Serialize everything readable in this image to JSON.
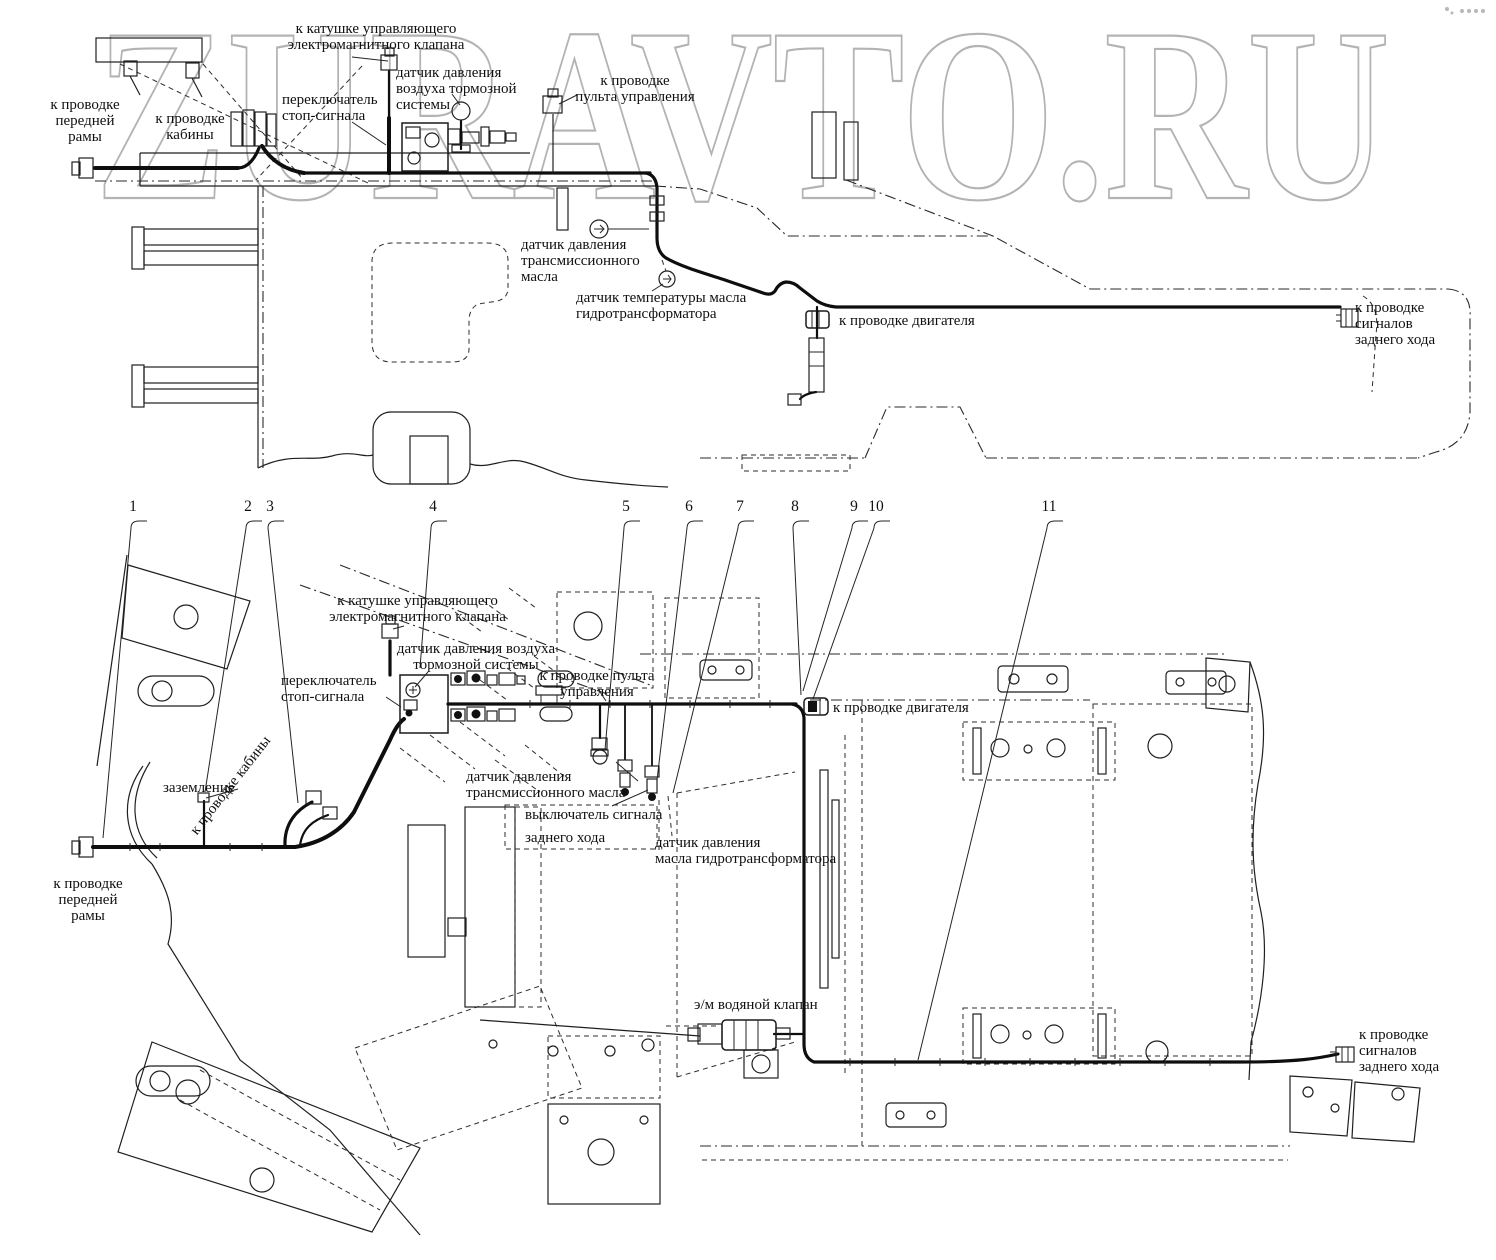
{
  "watermark": {
    "text": "ZURAVTO.RU"
  },
  "diagram": {
    "upper_labels": {
      "coil": "к катушке управляющего\nэлектромагнитного клапана",
      "air_sensor": "датчик давления\nвоздуха тормозной\nсистемы",
      "stop_switch": "переключатель\nстоп-сигнала",
      "front_frame": "к проводке\nпередней\nрамы",
      "cab": "к проводке\nкабины",
      "control_panel": "к проводке\nпульта управления",
      "trans_oil": "датчик давления\nтрансмиссионного\nмасла",
      "oil_temp": "датчик температуры масла\nгидротрансформатора",
      "engine": "к проводке двигателя",
      "reverse": "к проводке\nсигналов\nзаднего хода"
    },
    "lower_labels": {
      "coil": "к катушке управляющего\nэлектромагнитного клапана",
      "air_sensor": "датчик давления воздуха\nтормозной системы",
      "stop_switch": "переключатель\nстоп-сигнала",
      "control_panel": "к проводке пульта\nуправления",
      "ground": "заземление",
      "cab": "к проводке кабины",
      "engine": "к проводке двигателя",
      "trans_oil": "датчик давления\nтрансмиссионного масла",
      "reverse_switch": "выключатель сигнала\nзаднего хода",
      "hydro_oil": "датчик давления\nмасла гидротрансформатора",
      "water_valve": "э/м водяной клапан",
      "reverse": "к проводке\nсигналов\nзаднего хода",
      "front_frame": "к проводке\nпередней\nрамы"
    },
    "callouts": [
      "1",
      "2",
      "3",
      "4",
      "5",
      "6",
      "7",
      "8",
      "9",
      "10",
      "11"
    ]
  },
  "colors": {
    "ink": "#1a1a1a",
    "watermark_stroke": "#a6a6a6",
    "background": "#ffffff"
  }
}
